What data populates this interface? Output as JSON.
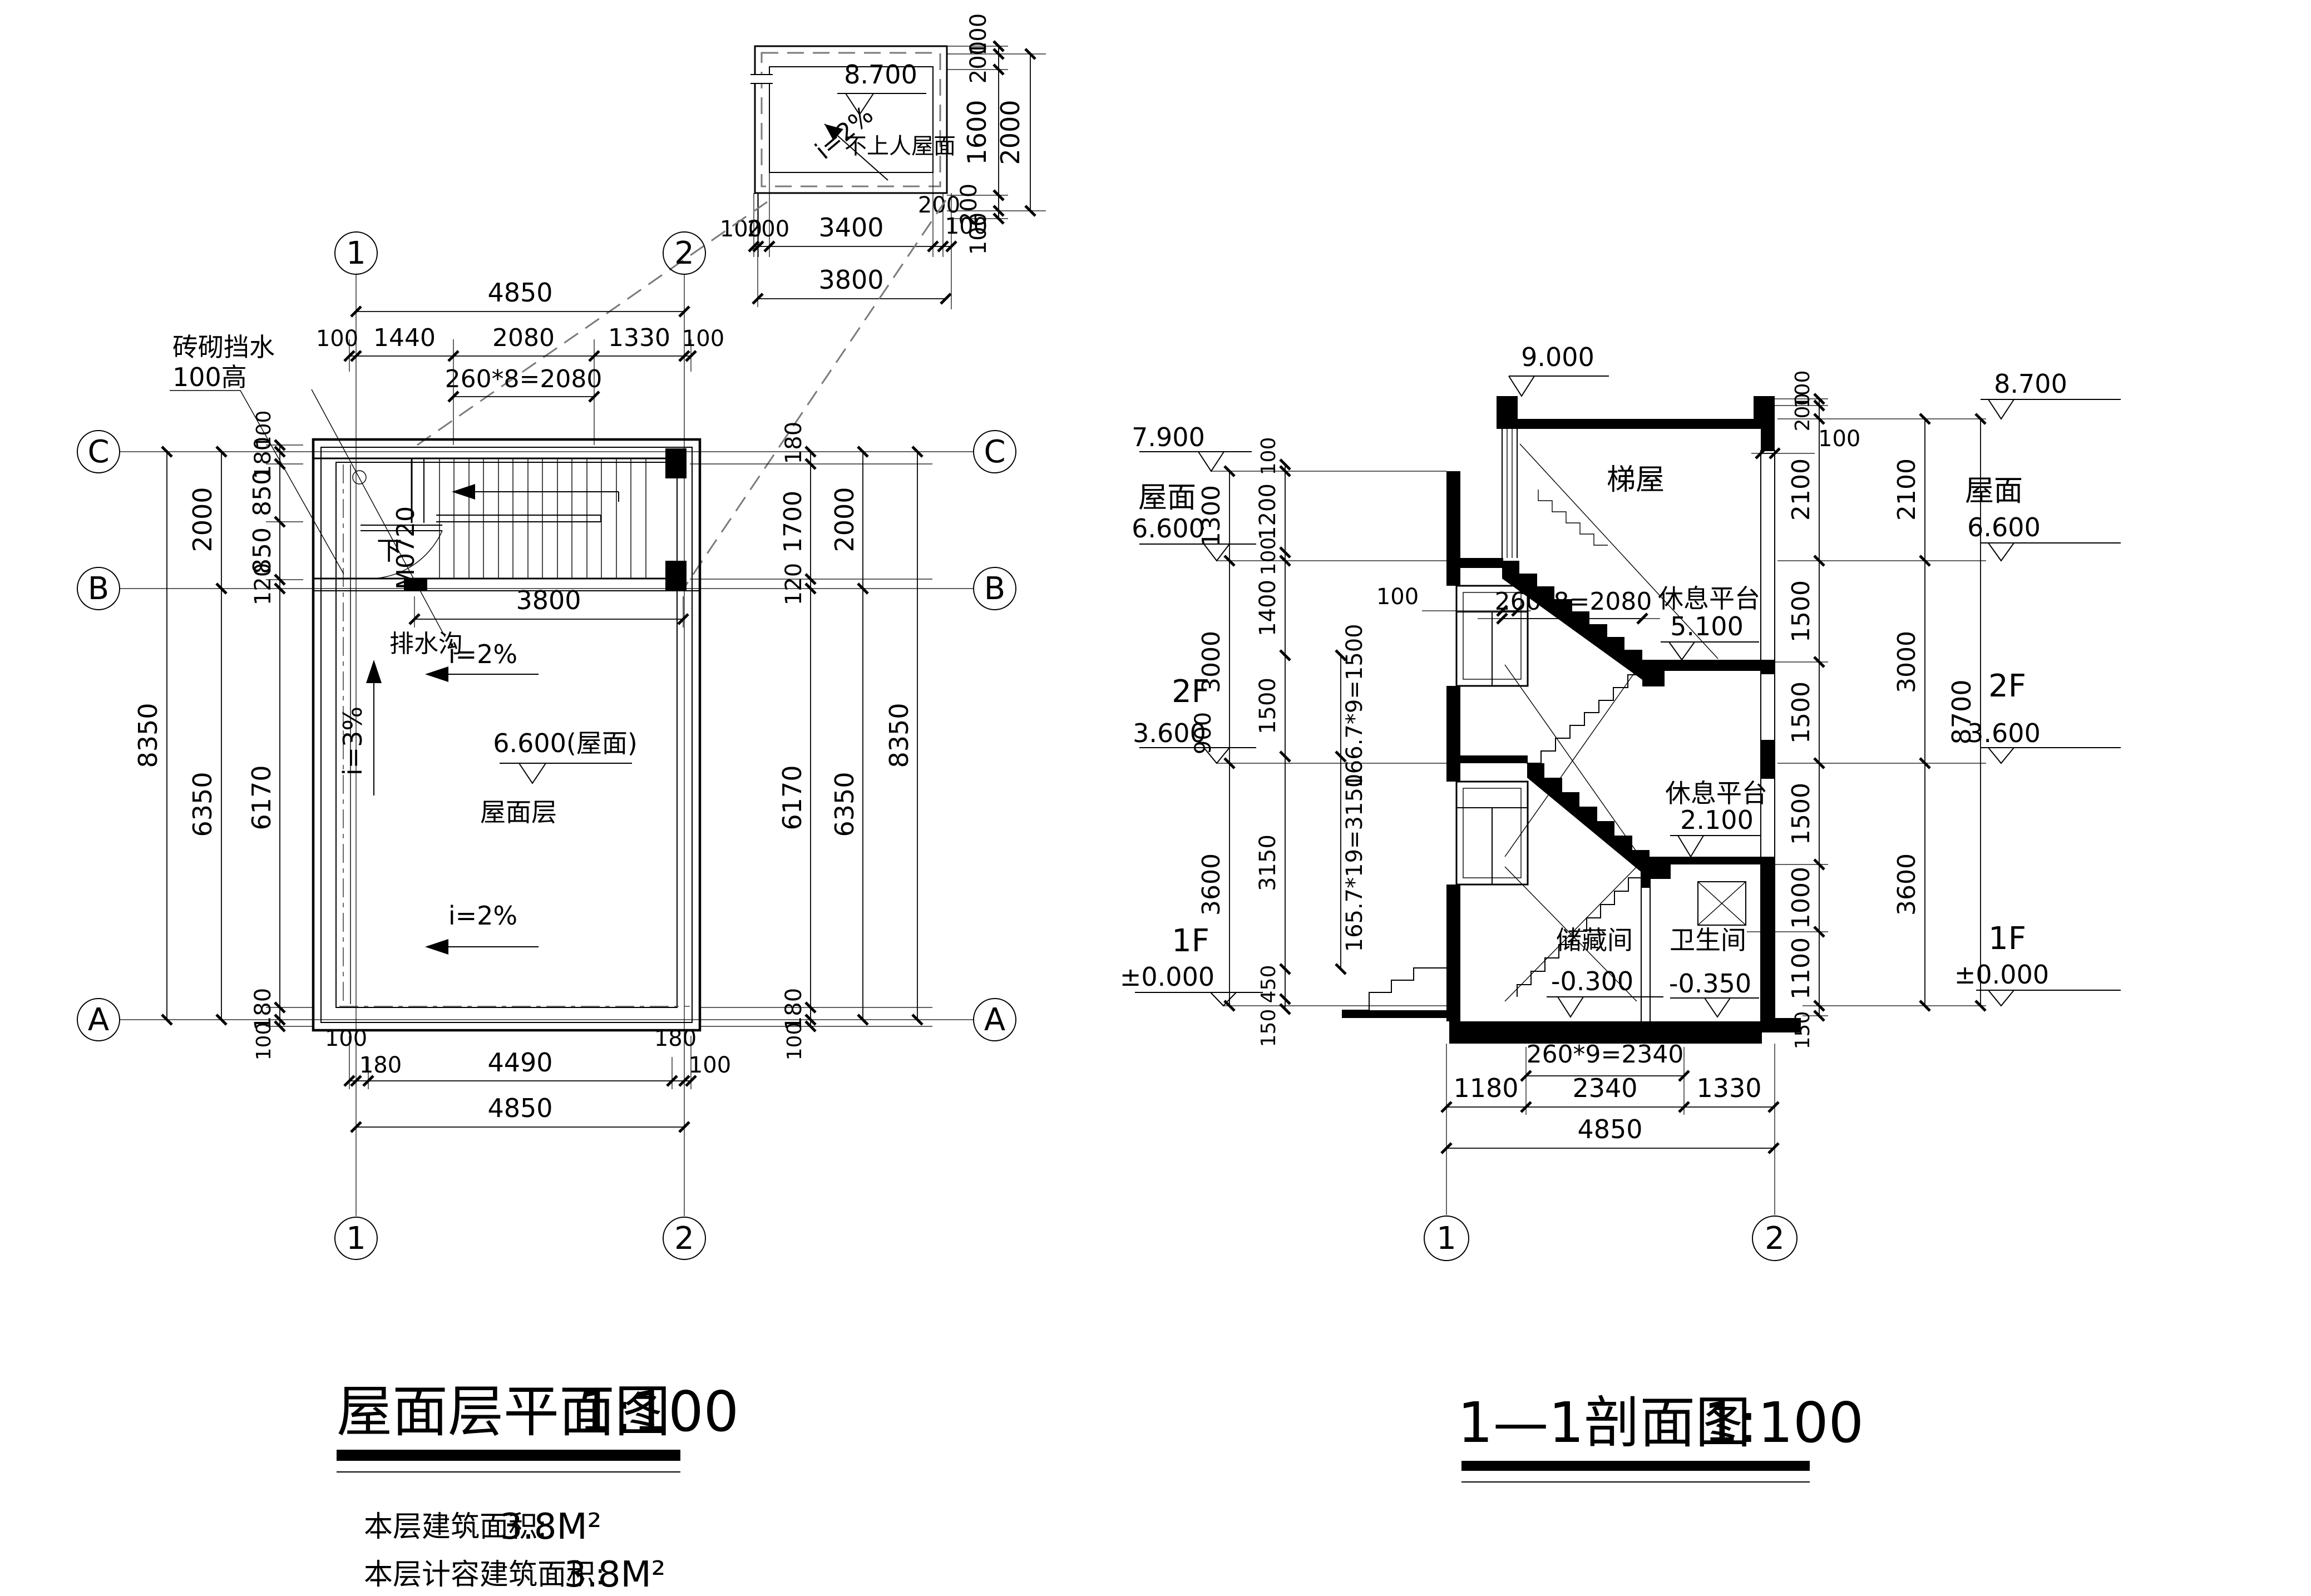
{
  "detail": {
    "level": "8.700",
    "slope": "i=2%",
    "roof_note": "不上人屋面",
    "bottom": [
      "100",
      "200",
      "3400",
      "200",
      "100"
    ],
    "bottom_total": "3800",
    "right": [
      "100",
      "200",
      "1600",
      "200",
      "100"
    ],
    "right_total": "2000"
  },
  "plan": {
    "axis1": "1",
    "axis2": "2",
    "axisC": "C",
    "axisB": "B",
    "axisA": "A",
    "top": {
      "total": "4850",
      "chain": [
        "100",
        "1440",
        "2080",
        "1330",
        "100"
      ],
      "stair": "260*8=2080"
    },
    "left": {
      "chain": [
        "100",
        "180",
        "850",
        "850",
        "120",
        "6170",
        "180",
        "100"
      ],
      "mid": [
        "2000",
        "6350"
      ],
      "outer": "8350"
    },
    "right": {
      "chain": [
        "180",
        "1700",
        "120",
        "6170",
        "180",
        "100"
      ],
      "mid": [
        "2000",
        "6350"
      ],
      "outer": "8350"
    },
    "bottom": {
      "chain": [
        "100",
        "180",
        "4490",
        "180",
        "100"
      ],
      "total": "4850"
    },
    "stair_width": "3800",
    "parapet_note1": "砖砌挡水",
    "parapet_note2": "100高",
    "door_tag": "M0720",
    "down": "下",
    "gutter": "排水沟",
    "slope1": "i=2%",
    "slope2": "i=2%",
    "slope_v": "i=3%",
    "roof_level": "6.600(屋面)",
    "roof_layer": "屋面层",
    "title": "屋面层平面图",
    "title_scale": "1:100",
    "note1_label": "本层建筑面积:",
    "note1_value": "3.8M²",
    "note2_label": "本层计容建筑面积:",
    "note2_value": "3.8M²"
  },
  "section": {
    "axis1": "1",
    "axis2": "2",
    "lv9": "9.000",
    "lv79": "7.900",
    "roof_l": "屋面",
    "lv66_l": "6.600",
    "f2_l": "2F",
    "lv36_l": "3.600",
    "f1_l": "1F",
    "lv0_l": "±0.000",
    "lv87_r": "8.700",
    "roof_r": "屋面",
    "lv66_r": "6.600",
    "f2_r": "2F",
    "lv36_r": "3.600",
    "f1_r": "1F",
    "lv0_r": "±0.000",
    "stair_room": "梯屋",
    "landing1": "休息平台",
    "landing1_lv": "5.100",
    "landing2": "休息平台",
    "landing2_lv": "2.100",
    "storage": "储藏间",
    "storage_lv": "-0.300",
    "bath": "卫生间",
    "bath_lv": "-0.350",
    "stair_dim_top": "260*8=2080",
    "stair_dim_bottom": "260*9=2340",
    "wall100_l": "100",
    "wall100_r": "100",
    "leftchain1": [
      "1300",
      "3000",
      "3600"
    ],
    "leftchain2": [
      "100",
      "1200",
      "100",
      "1400",
      "1500",
      "3150",
      "450",
      "150"
    ],
    "leftchain3": [
      "166.7*9=1500",
      "165.7*19=3150"
    ],
    "d900": "900",
    "rightchain1": [
      "100",
      "200",
      "2100",
      "1500",
      "1500",
      "1500",
      "1000",
      "1100",
      "150"
    ],
    "rightchain2": [
      "2100",
      "3000",
      "3600"
    ],
    "rightchain3": "8700",
    "bottom": {
      "chain": [
        "1180",
        "2340",
        "1330"
      ],
      "total": "4850"
    },
    "title": "1—1剖面图",
    "title_scale": "1:100"
  }
}
